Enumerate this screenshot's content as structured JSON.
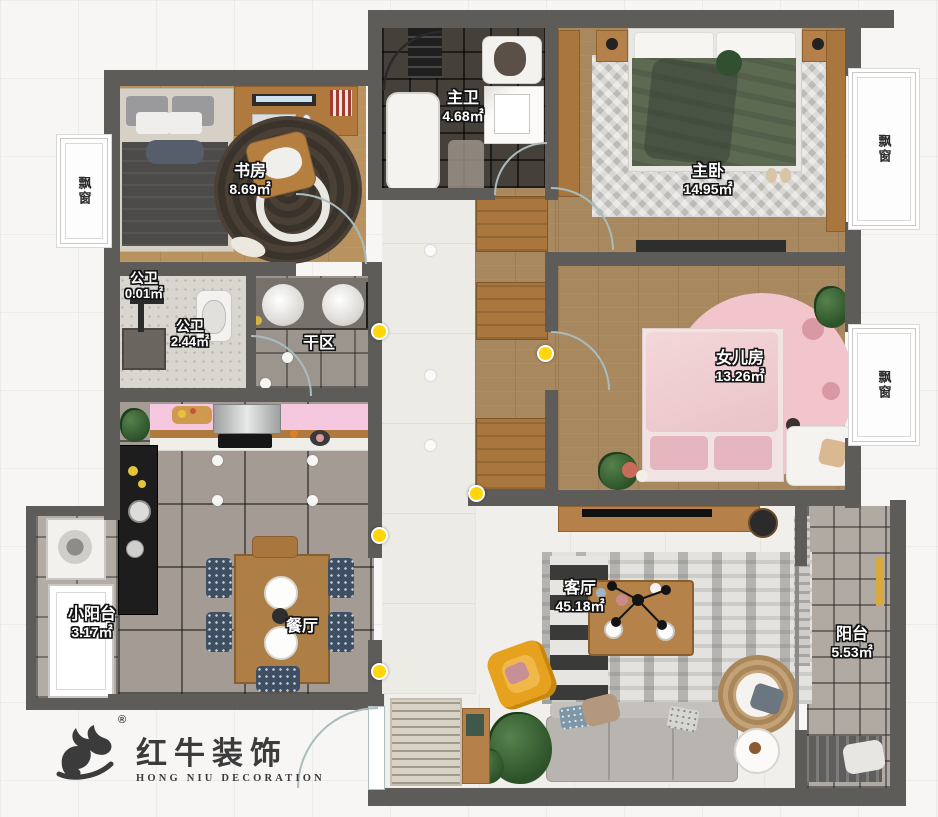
{
  "brand": {
    "logo_cn": "红牛装饰",
    "logo_en": "HONG NIU DECORATION",
    "registered_mark": "®"
  },
  "rooms": [
    {
      "id": "study",
      "name": "书房",
      "area": "8.69㎡"
    },
    {
      "id": "master-bath",
      "name": "主卫",
      "area": "4.68㎡"
    },
    {
      "id": "master-bedroom",
      "name": "主卧",
      "area": "14.95㎡"
    },
    {
      "id": "public-bath-shower",
      "name": "公卫",
      "area": "0.01㎡"
    },
    {
      "id": "public-bath-wc",
      "name": "公卫",
      "area": "2.44㎡"
    },
    {
      "id": "dry-area",
      "name": "干区",
      "area": ""
    },
    {
      "id": "daughter-room",
      "name": "女儿房",
      "area": "13.26㎡"
    },
    {
      "id": "small-balcony",
      "name": "小阳台",
      "area": "3.17㎡"
    },
    {
      "id": "dining-room",
      "name": "餐厅",
      "area": ""
    },
    {
      "id": "living-room",
      "name": "客厅",
      "area": "45.18㎡"
    },
    {
      "id": "balcony",
      "name": "阳台",
      "area": "5.53㎡"
    }
  ],
  "bay_windows": [
    {
      "id": "left",
      "label": "飘窗"
    },
    {
      "id": "right-top",
      "label": "飘窗"
    },
    {
      "id": "right-middle",
      "label": "飘窗"
    }
  ],
  "colors": {
    "wall": "#5e5c59",
    "wood_floor": "#b9935f",
    "dark_bath_tile": "#45403a",
    "gray_tile": "#a49c94",
    "hall_floor": "#edebe6",
    "kitchen_counter_pink": "#f5c8df",
    "daughter_pink_rug": "#f1c5cb",
    "master_bed_green": "#5c6a52",
    "switch_marker_yellow": "#ffd60a",
    "armchair_yellow": "#e6a21f",
    "logo_gray": "#3b3b3b"
  }
}
